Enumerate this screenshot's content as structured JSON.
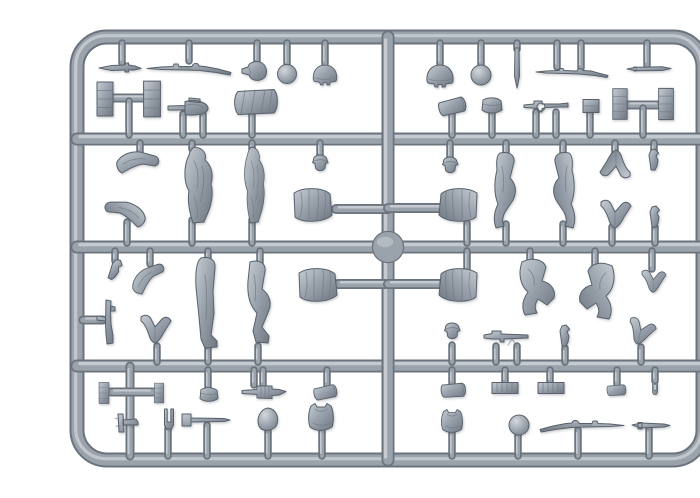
{
  "meta": {
    "description": "Grey injection-moulded plastic model sprue holding 1/35 scale soldier figure parts: greatcoat torsos, legs, bent arms, heads, helmets, rifles with bayonets, an MP40, machine guns, ammunition crates, mess tins, pouches, an entrenching shovel and other field equipment, photographed on a white background."
  },
  "colors": {
    "background": "#ffffff",
    "plastic_dark": "#6b737d",
    "plastic_mid": "#9aa2ac",
    "plastic_light": "#ccd1d6",
    "part_dark": "#6f7781",
    "part_mid": "#9aa3ad",
    "part_light": "#c6ccd2",
    "outline": "#59616b"
  },
  "canvas": {
    "width": 700,
    "height": 466
  },
  "sprue": {
    "frame": {
      "x": 37,
      "y": 21,
      "width": 626,
      "height": 423,
      "radius": 30,
      "thickness": 13
    },
    "boss": {
      "cx": 348,
      "cy": 231,
      "r": 15
    },
    "runners": [
      {
        "name": "runner-top",
        "x1": 37,
        "y1": 123,
        "x2": 663,
        "y2": 123,
        "w": 11
      },
      {
        "name": "runner-middle",
        "x1": 37,
        "y1": 231,
        "x2": 663,
        "y2": 231,
        "w": 11
      },
      {
        "name": "runner-bottom",
        "x1": 37,
        "y1": 350,
        "x2": 663,
        "y2": 350,
        "w": 11
      },
      {
        "name": "runner-center-vertical",
        "x1": 348,
        "y1": 21,
        "x2": 348,
        "y2": 444,
        "w": 11
      },
      {
        "name": "runner-left-bottom-vertical",
        "x1": 90,
        "y1": 350,
        "x2": 90,
        "y2": 440,
        "w": 7
      },
      {
        "name": "torso-arm-upper-left",
        "x1": 296,
        "y1": 193,
        "x2": 348,
        "y2": 193,
        "w": 8
      },
      {
        "name": "torso-arm-upper-right",
        "x1": 348,
        "y1": 192,
        "x2": 403,
        "y2": 192,
        "w": 8
      },
      {
        "name": "torso-arm-lower-left",
        "x1": 298,
        "y1": 268,
        "x2": 348,
        "y2": 268,
        "w": 8
      },
      {
        "name": "torso-arm-lower-right",
        "x1": 348,
        "y1": 268,
        "x2": 401,
        "y2": 268,
        "w": 8
      },
      {
        "name": "crate-bar-top-left",
        "x1": 71,
        "y1": 82,
        "x2": 107,
        "y2": 82,
        "w": 7
      },
      {
        "name": "crate-bar-top-right",
        "x1": 587,
        "y1": 89,
        "x2": 619,
        "y2": 89,
        "w": 7
      },
      {
        "name": "crate-bar-bottom-left",
        "x1": 71,
        "y1": 376,
        "x2": 113,
        "y2": 376,
        "w": 7
      },
      {
        "name": "smg-arm",
        "x1": 43,
        "y1": 304,
        "x2": 63,
        "y2": 304,
        "w": 7
      }
    ],
    "gates": [
      [
        82,
        27,
        47
      ],
      [
        149,
        27,
        45
      ],
      [
        217,
        27,
        46
      ],
      [
        247,
        27,
        49
      ],
      [
        285,
        27,
        48
      ],
      [
        400,
        27,
        48
      ],
      [
        441,
        27,
        49
      ],
      [
        477,
        27,
        33
      ],
      [
        517,
        27,
        51
      ],
      [
        541,
        27,
        52
      ],
      [
        607,
        27,
        49
      ],
      [
        89,
        85,
        119
      ],
      [
        143,
        98,
        119
      ],
      [
        163,
        98,
        119
      ],
      [
        212,
        97,
        119
      ],
      [
        412,
        96,
        119
      ],
      [
        452,
        96,
        119
      ],
      [
        496,
        96,
        119
      ],
      [
        516,
        96,
        119
      ],
      [
        550,
        95,
        119
      ],
      [
        603,
        92,
        119
      ],
      [
        100,
        127,
        136
      ],
      [
        152,
        127,
        133
      ],
      [
        212,
        127,
        133
      ],
      [
        280,
        127,
        140
      ],
      [
        410,
        127,
        142
      ],
      [
        466,
        127,
        139
      ],
      [
        523,
        127,
        139
      ],
      [
        575,
        127,
        138
      ],
      [
        614,
        127,
        136
      ],
      [
        87,
        206,
        227
      ],
      [
        152,
        204,
        227
      ],
      [
        212,
        204,
        227
      ],
      [
        427,
        207,
        227
      ],
      [
        466,
        208,
        227
      ],
      [
        523,
        208,
        227
      ],
      [
        572,
        211,
        227
      ],
      [
        615,
        211,
        227
      ],
      [
        75,
        235,
        245
      ],
      [
        110,
        235,
        248
      ],
      [
        168,
        235,
        243
      ],
      [
        220,
        235,
        247
      ],
      [
        427,
        235,
        254
      ],
      [
        490,
        235,
        246
      ],
      [
        555,
        235,
        252
      ],
      [
        612,
        235,
        253
      ],
      [
        117,
        330,
        346
      ],
      [
        168,
        331,
        346
      ],
      [
        218,
        330,
        346
      ],
      [
        412,
        329,
        346
      ],
      [
        456,
        330,
        346
      ],
      [
        477,
        330,
        346
      ],
      [
        525,
        332,
        346
      ],
      [
        601,
        331,
        346
      ],
      [
        168,
        354,
        372
      ],
      [
        214,
        354,
        369
      ],
      [
        223,
        354,
        369
      ],
      [
        287,
        354,
        369
      ],
      [
        412,
        354,
        368
      ],
      [
        465,
        354,
        366
      ],
      [
        510,
        354,
        366
      ],
      [
        577,
        354,
        368
      ],
      [
        615,
        354,
        365
      ],
      [
        128,
        412,
        440
      ],
      [
        167,
        409,
        440
      ],
      [
        228,
        415,
        440
      ],
      [
        282,
        413,
        440
      ],
      [
        412,
        416,
        440
      ],
      [
        478,
        418,
        440
      ],
      [
        538,
        414,
        440
      ],
      [
        609,
        413,
        440
      ]
    ],
    "parts": [
      {
        "name": "bayonet-1",
        "type": "bayonet",
        "x": 80,
        "y": 52
      },
      {
        "name": "rifle-1",
        "type": "rifle",
        "x": 149,
        "y": 52
      },
      {
        "name": "canteen-1",
        "type": "canteen",
        "x": 215,
        "y": 55
      },
      {
        "name": "head-ball-1",
        "type": "ball",
        "x": 247,
        "y": 58,
        "s": 0.95
      },
      {
        "name": "helmet-1",
        "type": "helmet",
        "x": 285,
        "y": 59,
        "s": 0.9
      },
      {
        "name": "helmet-2",
        "type": "helmet",
        "x": 400,
        "y": 60
      },
      {
        "name": "head-ball-2",
        "type": "ball",
        "x": 441,
        "y": 59
      },
      {
        "name": "peg-1",
        "type": "peg",
        "x": 477,
        "y": 52
      },
      {
        "name": "rifle-bayonet-1",
        "type": "rifleb",
        "x": 532,
        "y": 56
      },
      {
        "name": "cleaning-rod-1",
        "type": "rod",
        "x": 609,
        "y": 53
      },
      {
        "name": "ammo-crate-1",
        "type": "crate",
        "x": 65,
        "y": 83
      },
      {
        "name": "ammo-crate-2",
        "type": "crate",
        "x": 112,
        "y": 83,
        "s": 1.05
      },
      {
        "name": "shovel-1",
        "type": "shovel",
        "x": 151,
        "y": 92
      },
      {
        "name": "coat-roll-1",
        "type": "roll",
        "x": 216,
        "y": 86
      },
      {
        "name": "mess-tin-1",
        "type": "messtin",
        "x": 413,
        "y": 90,
        "rot": -10
      },
      {
        "name": "pouch-1",
        "type": "pouch",
        "x": 452,
        "y": 90
      },
      {
        "name": "mg34-1",
        "type": "mg34",
        "x": 506,
        "y": 90
      },
      {
        "name": "ammo-box-1",
        "type": "box",
        "x": 551,
        "y": 90
      },
      {
        "name": "ammo-crate-3",
        "type": "crate",
        "x": 580,
        "y": 88,
        "s": 0.9
      },
      {
        "name": "ammo-crate-4",
        "type": "crate",
        "x": 626,
        "y": 88,
        "s": 0.92
      },
      {
        "name": "arm-1",
        "type": "armB",
        "x": 99,
        "y": 146
      },
      {
        "name": "arm-2",
        "type": "armB",
        "x": 84,
        "y": 196,
        "rot": 15,
        "sx": -1
      },
      {
        "name": "greatcoat-figure-1",
        "type": "coat",
        "x": 158,
        "y": 169
      },
      {
        "name": "greatcoat-figure-2",
        "type": "coat",
        "x": 214,
        "y": 169,
        "sx": 0.72
      },
      {
        "name": "head-1",
        "type": "head",
        "x": 280,
        "y": 148
      },
      {
        "name": "torso-1",
        "type": "torso",
        "x": 273,
        "y": 190
      },
      {
        "name": "head-2",
        "type": "head",
        "x": 410,
        "y": 150
      },
      {
        "name": "walking-legs-1",
        "type": "walk",
        "x": 466,
        "y": 174
      },
      {
        "name": "walking-legs-2",
        "type": "walk",
        "x": 523,
        "y": 174,
        "sx": -1
      },
      {
        "name": "arms-pair-1",
        "type": "armV",
        "x": 575,
        "y": 147,
        "rot": 180
      },
      {
        "name": "hand-1",
        "type": "hand",
        "x": 614,
        "y": 144
      },
      {
        "name": "torso-2",
        "type": "torso",
        "x": 418,
        "y": 190,
        "sx": -1
      },
      {
        "name": "arms-pair-2",
        "type": "armV",
        "x": 576,
        "y": 199
      },
      {
        "name": "hand-2",
        "type": "hand",
        "x": 615,
        "y": 201
      },
      {
        "name": "hand-3",
        "type": "hand",
        "x": 75,
        "y": 254,
        "rot": 25
      },
      {
        "name": "arm-3",
        "type": "armB",
        "x": 109,
        "y": 261,
        "rot": -35,
        "s": 0.9
      },
      {
        "name": "leg-straight-1",
        "type": "legS",
        "x": 168,
        "y": 287
      },
      {
        "name": "leg-bent-1",
        "type": "legB",
        "x": 219,
        "y": 287
      },
      {
        "name": "torso-3",
        "type": "torso",
        "x": 278,
        "y": 270
      },
      {
        "name": "torso-4",
        "type": "torso",
        "x": 418,
        "y": 270,
        "sx": -1
      },
      {
        "name": "kneeling-legs-1",
        "type": "kneel",
        "x": 497,
        "y": 271
      },
      {
        "name": "kneeling-legs-2",
        "type": "kneel",
        "x": 557,
        "y": 275,
        "sx": -1
      },
      {
        "name": "arms-pair-3",
        "type": "armV",
        "x": 614,
        "y": 266,
        "s": 0.8
      },
      {
        "name": "smg-1",
        "type": "smg",
        "x": 68,
        "y": 306
      },
      {
        "name": "arm-4",
        "type": "armV",
        "x": 116,
        "y": 314
      },
      {
        "name": "head-3",
        "type": "head",
        "x": 412,
        "y": 316
      },
      {
        "name": "mg42-1",
        "type": "mg42",
        "x": 466,
        "y": 321
      },
      {
        "name": "hand-4",
        "type": "hand",
        "x": 525,
        "y": 320
      },
      {
        "name": "arm-5",
        "type": "armV",
        "x": 601,
        "y": 317,
        "rot": 15,
        "s": 0.9
      },
      {
        "name": "ammo-crate-5",
        "type": "crate",
        "x": 64,
        "y": 377,
        "s": 0.62
      },
      {
        "name": "ammo-crate-6",
        "type": "crate",
        "x": 119,
        "y": 377,
        "s": 0.58
      },
      {
        "name": "pistol-1",
        "type": "pistol",
        "x": 88,
        "y": 407
      },
      {
        "name": "fork-1",
        "type": "fork",
        "x": 129,
        "y": 404
      },
      {
        "name": "pick-hammer-1",
        "type": "pickhammer",
        "x": 166,
        "y": 404
      },
      {
        "name": "pouch-2",
        "type": "pouch",
        "x": 169,
        "y": 379,
        "s": 0.9
      },
      {
        "name": "spoon-1",
        "type": "spoon",
        "x": 228,
        "y": 404
      },
      {
        "name": "ammo-belt-1",
        "type": "belt",
        "x": 224,
        "y": 376
      },
      {
        "name": "tunic-1",
        "type": "tunic",
        "x": 281,
        "y": 401
      },
      {
        "name": "mess-tin-2",
        "type": "messtin",
        "x": 286,
        "y": 376,
        "rot": -8,
        "s": 0.85
      },
      {
        "name": "mess-tin-3",
        "type": "messtin",
        "x": 414,
        "y": 374,
        "s": 0.9
      },
      {
        "name": "ribbed-box-1",
        "type": "ribbox",
        "x": 465,
        "y": 372
      },
      {
        "name": "ribbed-box-2",
        "type": "ribbox",
        "x": 511,
        "y": 372
      },
      {
        "name": "cylinder-1",
        "type": "messtin",
        "x": 577,
        "y": 374,
        "s": 0.7
      },
      {
        "name": "fork-2",
        "type": "fork",
        "x": 615,
        "y": 373,
        "s": 0.6
      },
      {
        "name": "tunic-2",
        "type": "tunic",
        "x": 412,
        "y": 405,
        "s": 0.85
      },
      {
        "name": "head-ball-3",
        "type": "ball",
        "x": 479,
        "y": 409
      },
      {
        "name": "rifle-2",
        "type": "rifle",
        "x": 542,
        "y": 409,
        "sx": -1
      },
      {
        "name": "pick-1",
        "type": "pick",
        "x": 611,
        "y": 410
      }
    ]
  }
}
